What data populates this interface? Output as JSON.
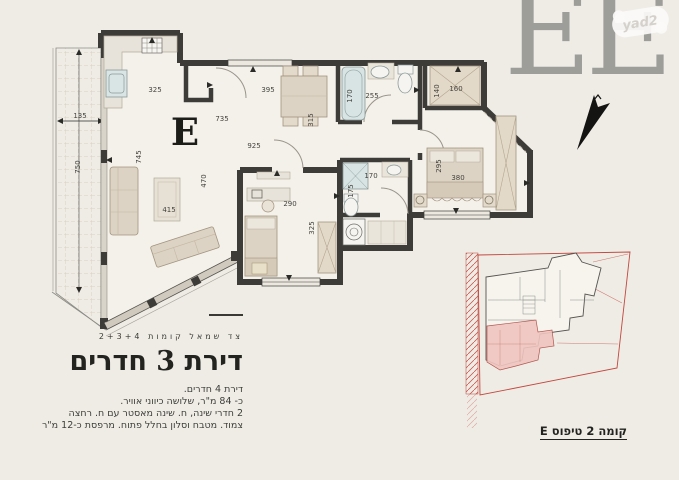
{
  "logo": {
    "text": "EE",
    "watermark": "yad2"
  },
  "colors": {
    "background": "#efece6",
    "wall": "#3e3c38",
    "furniture": "#ddd3c4",
    "fixture_blue": "#d8e4e4",
    "highlight_unit_pink": "#efc4bf",
    "boundary_red": "#c2473d",
    "logo_gray": "#9d9d9a"
  },
  "floor_plan": {
    "unit_letter": "E",
    "dimensions": {
      "kitchen_width": "325",
      "dining_width": "395",
      "dining_depth": "315",
      "wc_width": "255",
      "bath_tub_length": "170",
      "closet_depth": "140",
      "closet_width": "160",
      "entry_hall": "735",
      "hallway": "925",
      "living_length": "745",
      "living_width": "470",
      "rug": "415",
      "balcony_width": "135",
      "balcony_length": "750",
      "bedroom2_width": "290",
      "bedroom2_depth": "325",
      "bath2_width": "170",
      "bath2_depth": "175",
      "master_width": "380",
      "master_depth": "295"
    }
  },
  "description": {
    "floors_line": "צד שמאל קומות 2+3+4",
    "title": "דירת 3 חדרים",
    "lines": [
      "דירת 4 חדרים.",
      "כ- 84 מ\"ר, שלושה כיווני אוויר.",
      "2 חדרי שינה, ח. שינה מאסטר עם ח. רחצה",
      "צמוד. מטבח וסלון בחלל פתוח. מרפסת כ-12 מ\"ר"
    ]
  },
  "key_plan": {
    "caption": "קומה 2 טיפוס E"
  }
}
